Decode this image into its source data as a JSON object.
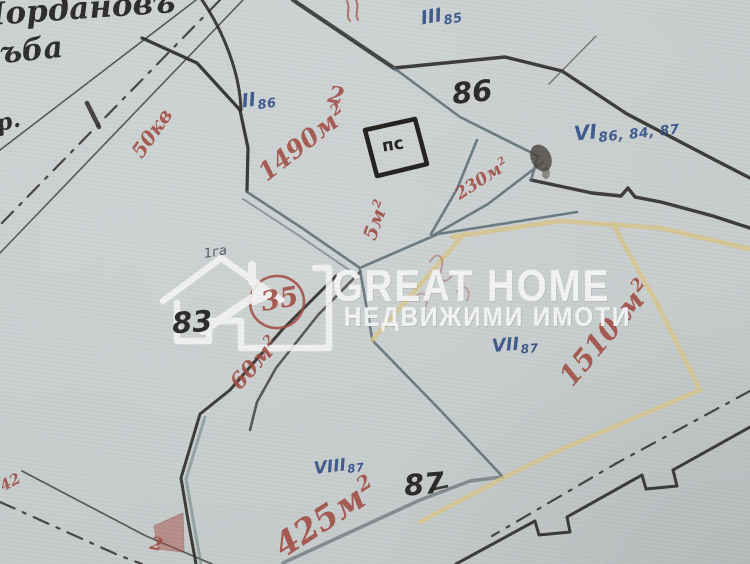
{
  "watermark": {
    "title": "GREAT HOME",
    "subtitle": "НЕДВИЖИМИ ИМОТИ",
    "logo": "house-arrow-icon"
  },
  "handwriting": {
    "top_line1": "Йордановъ",
    "top_line2": "ъба",
    "left_note": "р.",
    "tiny_note": "1га"
  },
  "plot_numbers": {
    "n86": "86",
    "n83": "83",
    "n87": "87"
  },
  "parcel_labels": {
    "iii": {
      "roman": "III",
      "sub": "85"
    },
    "ii": {
      "roman": "II",
      "sub": "86"
    },
    "vi": {
      "roman": "VI",
      "sub": "86, 84, 87"
    },
    "vii": {
      "roman": "VII",
      "sub": "87"
    },
    "viii": {
      "roman": "VIII",
      "sub": "87"
    }
  },
  "area_labels": {
    "a50": {
      "main": "50кв",
      "sup": ""
    },
    "a1490": {
      "main": "1490м",
      "sup": "2"
    },
    "a230": {
      "main": "230м",
      "sup": "2"
    },
    "a5": {
      "main": "5м",
      "sup": "2"
    },
    "a60": {
      "main": "60м",
      "sup": "2"
    },
    "a1510": {
      "main": "1510 м",
      "sup": "2"
    },
    "a425": {
      "main": "425м",
      "sup": "2"
    }
  },
  "red_notes": {
    "n42": "42",
    "two_top": "2",
    "two_bottom": "2",
    "circled_number": "35"
  },
  "building_label": "пс",
  "colors": {
    "paper": "#c8cdce",
    "ink_black": "#2c2a26",
    "ink_blue": "#2f4f86",
    "ink_red": "#a04a40",
    "pencil_grey": "#5a6c74",
    "pencil_teal": "#5f7a78",
    "pencil_yellow": "#d8c588",
    "watermark_white": "#f5f6f5"
  }
}
